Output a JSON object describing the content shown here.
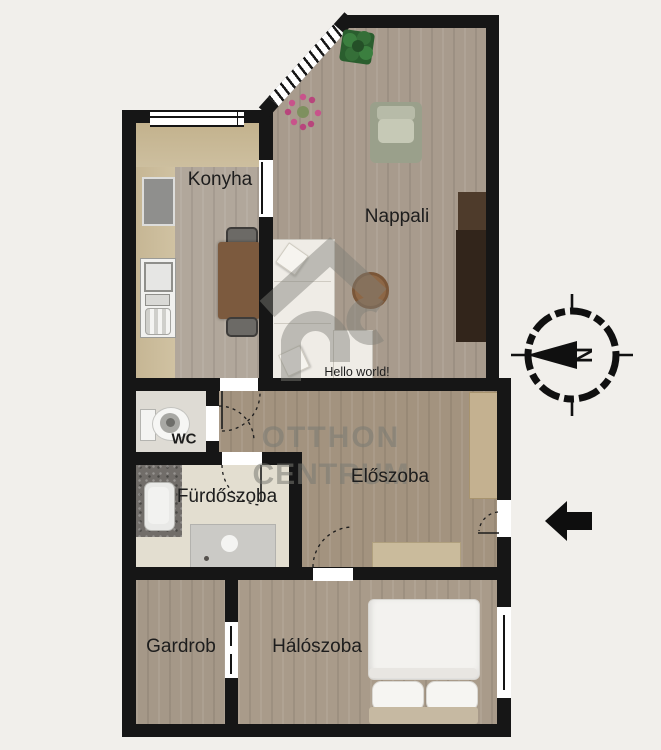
{
  "plan": {
    "title": "Apartment floor plan",
    "rooms": [
      {
        "id": "konyha",
        "label": "Konyha"
      },
      {
        "id": "nappali",
        "label": "Nappali"
      },
      {
        "id": "wc",
        "label": "WC"
      },
      {
        "id": "furdoszoba",
        "label": "Fürdőszoba"
      },
      {
        "id": "eloszoba",
        "label": "Előszoba"
      },
      {
        "id": "gardrob",
        "label": "Gardrob"
      },
      {
        "id": "haloszoba",
        "label": "Hálószoba"
      }
    ],
    "annotations": {
      "hello_text": "Hello world!"
    },
    "compass": {
      "letter": "N"
    },
    "watermark": {
      "line1": "OTTHON",
      "line2": "CENTRUM"
    },
    "icons": [
      "compass-icon",
      "entrance-arrow-icon",
      "plant-icon",
      "flower-icon"
    ],
    "colors": {
      "background": "#f1efeb",
      "wall": "#161616",
      "wood_floor": "#a79a8c",
      "tile_floor": "#e3ded0",
      "counter_tan": "#c9b795",
      "dark_furniture": "#32251b",
      "sofa_white": "#efece6",
      "armchair_sage": "#9aa08b",
      "watermark_gray": "#7f7f78"
    }
  }
}
